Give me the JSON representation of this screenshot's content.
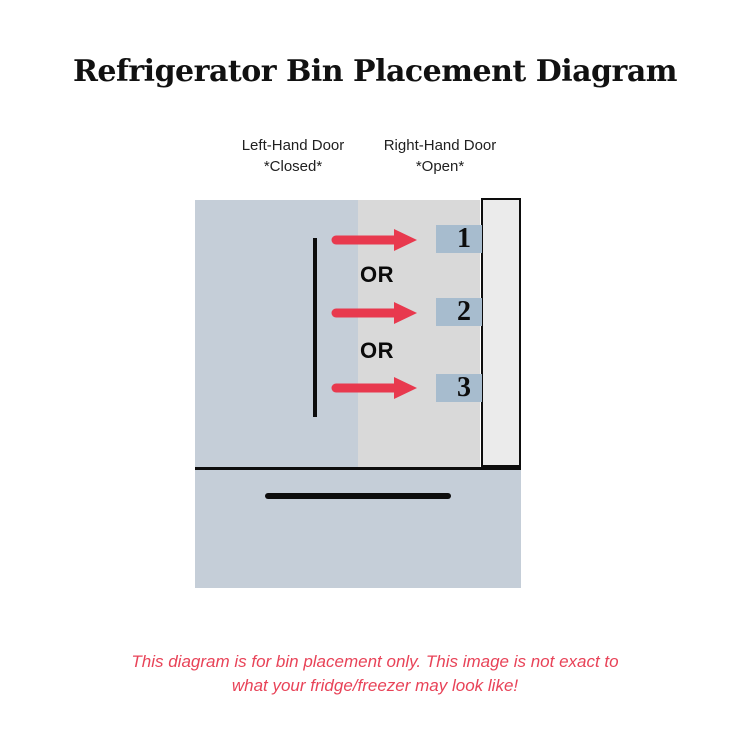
{
  "title": "Refrigerator Bin Placement Diagram",
  "labels": {
    "left_door": {
      "line1": "Left-Hand Door",
      "line2": "*Closed*"
    },
    "right_door": {
      "line1": "Right-Hand Door",
      "line2": "*Open*"
    }
  },
  "diagram": {
    "or_labels": [
      "OR",
      "OR"
    ],
    "bins": [
      {
        "label": "1"
      },
      {
        "label": "2"
      },
      {
        "label": "3"
      }
    ]
  },
  "disclaimer": {
    "line1": "This diagram is for bin placement only. This image is not exact to",
    "line2": "what your fridge/freezer may look like!"
  },
  "colors": {
    "arrow-red": "#e8394e",
    "disclaimer-red": "#e84358",
    "closed-door-gray-blue": "#c5ced8",
    "interior-gray": "#d9d9d9",
    "open-door-light": "#ebebeb",
    "bin-blue": "#a7bcce",
    "line-black": "#0d0d0d"
  }
}
